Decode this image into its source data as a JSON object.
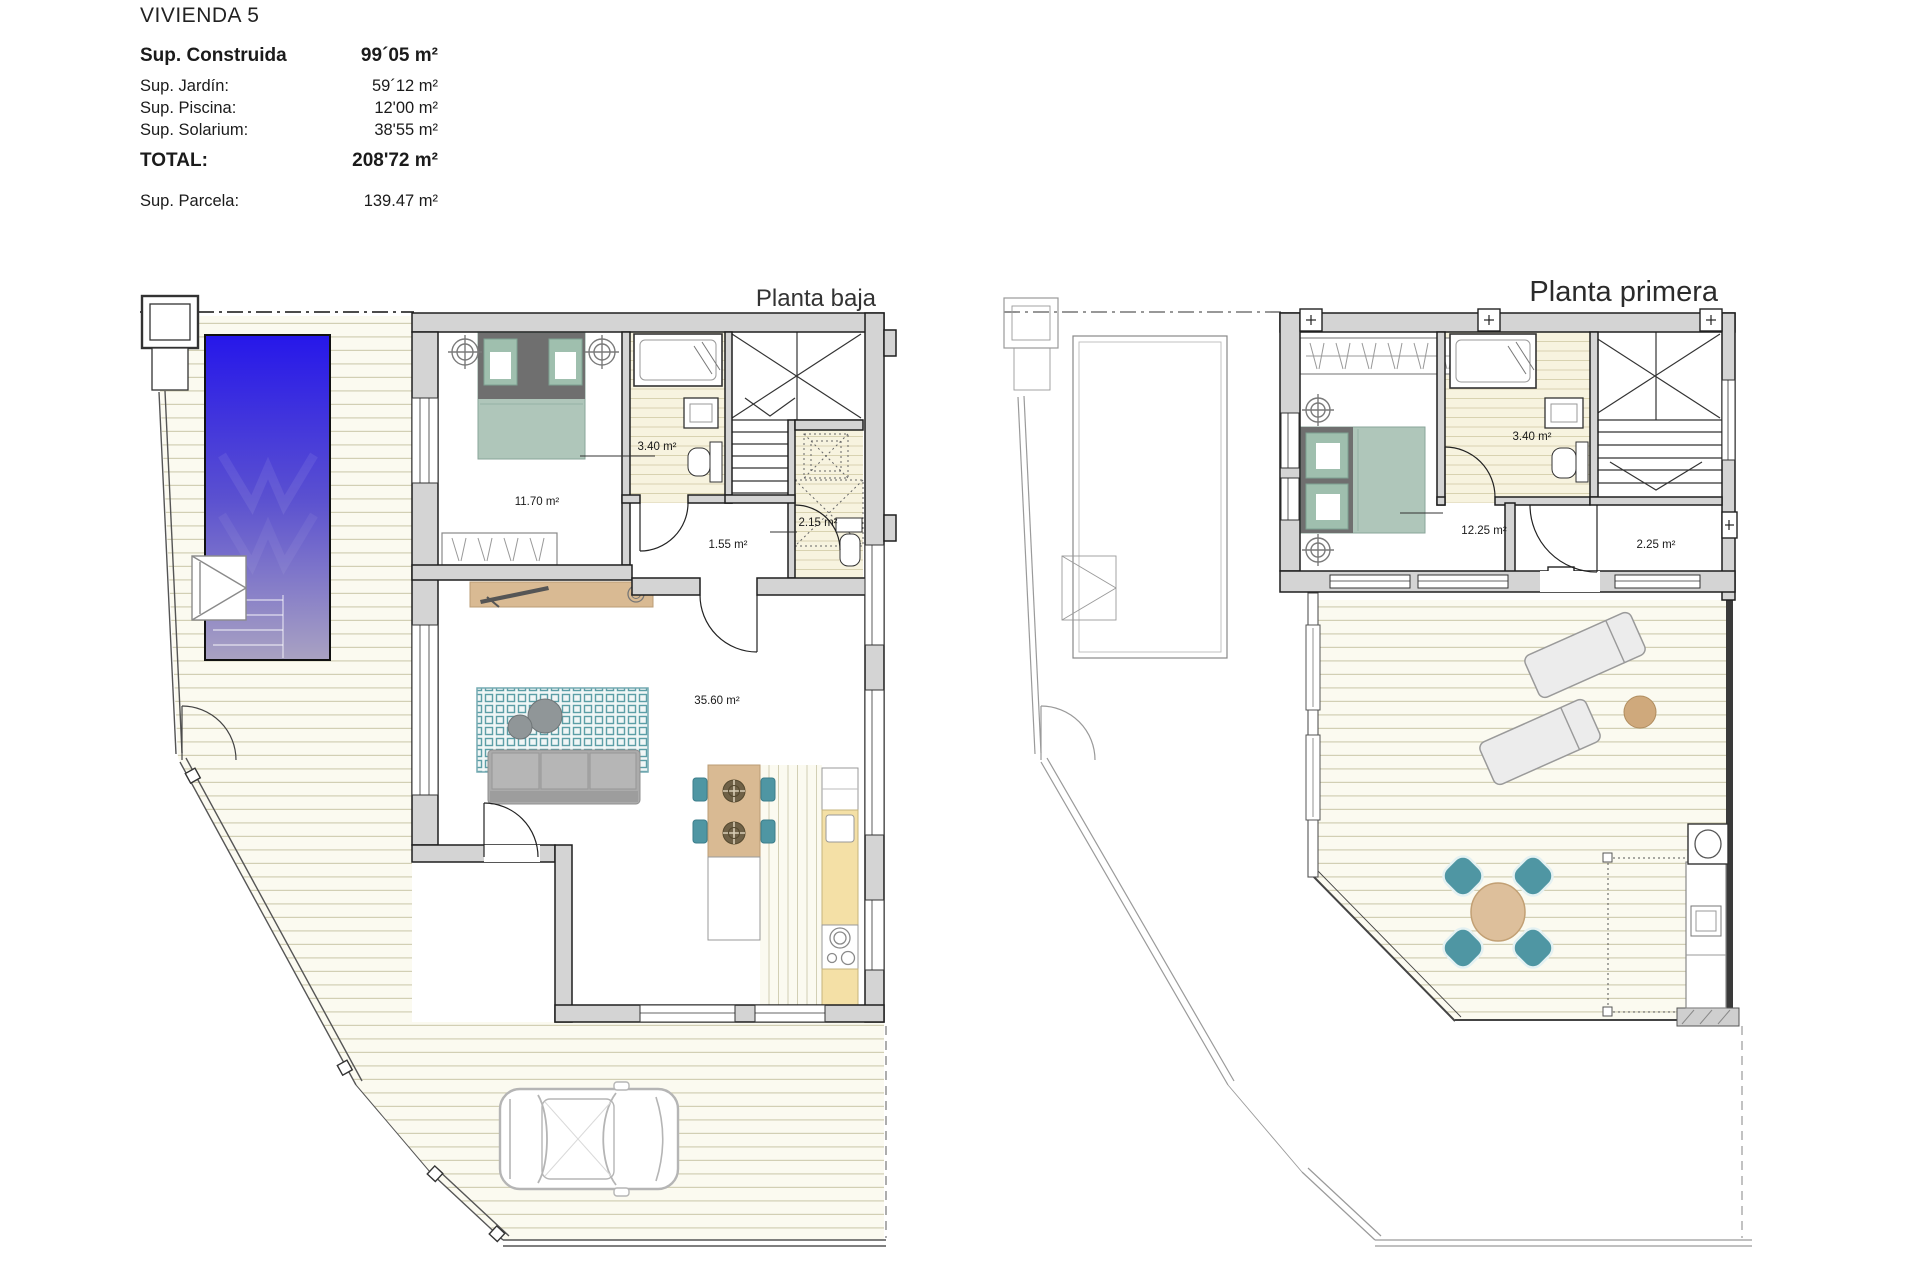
{
  "header": {
    "title": "VIVIENDA 5",
    "construida_label": "Sup. Construida",
    "construida_value": "99´05 m²",
    "jardin_label": "Sup. Jardín:",
    "jardin_value": "59´12 m²",
    "piscina_label": "Sup. Piscina:",
    "piscina_value": "12'00 m²",
    "solarium_label": "Sup. Solarium:",
    "solarium_value": "38'55 m²",
    "total_label": "TOTAL:",
    "total_value": "208'72 m²",
    "parcela_label": "Sup. Parcela:",
    "parcela_value": "139.47 m²"
  },
  "plans": {
    "baja": {
      "title": "Planta baja",
      "bedroom_area": "11.70 m²",
      "bath_area": "3.40 m²",
      "hall_area": "1.55 m²",
      "wc_area": "2.15 m²",
      "living_area": "35.60 m²"
    },
    "primera": {
      "title": "Planta primera",
      "bedroom_area": "12.25 m²",
      "bath_area": "3.40 m²",
      "hall_area": "2.25 m²"
    }
  },
  "colors": {
    "pool_top": "#2617ea",
    "pool_bottom": "#a9a2c2",
    "wall_fill": "#d4d4d4",
    "deck_floor": "#fbfaf0",
    "deck_line": "#d2cfb4",
    "bed_green": "#afc6ba",
    "rug_teal": "#5c9ea6",
    "chair_teal": "#4f96a3",
    "wood_tan": "#d9ba93",
    "counter_yellow": "#f4e0a6",
    "sofa_gray": "#ababab",
    "lounger_gray": "#ececec",
    "side_table_tan": "#cfa97c"
  }
}
